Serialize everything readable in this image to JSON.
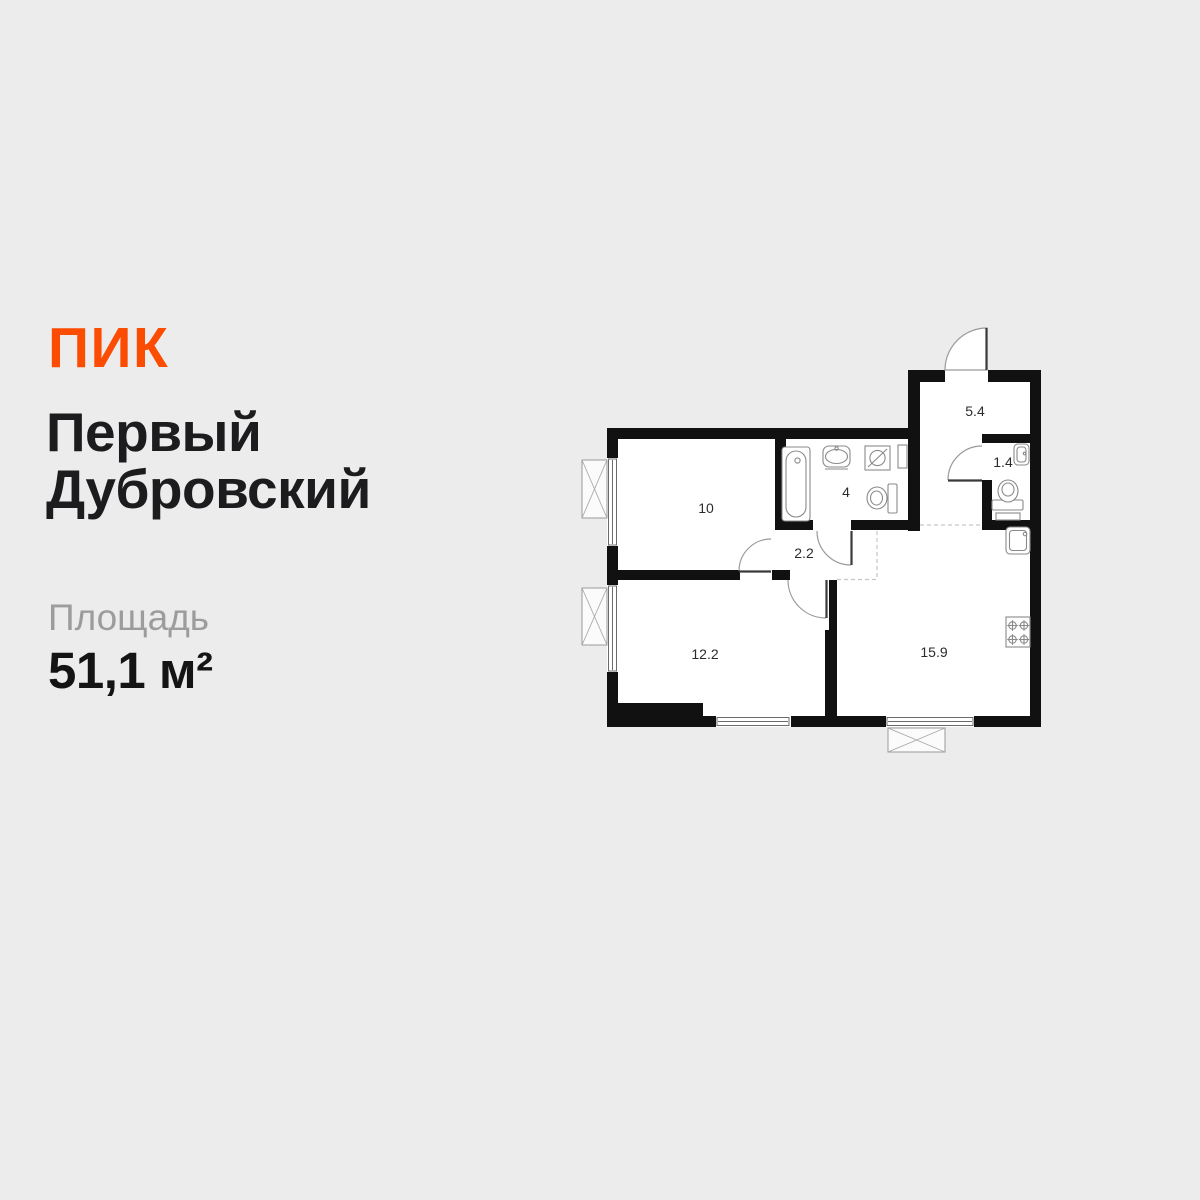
{
  "background_color": "#ECECEC",
  "brand": {
    "name": "ПИК",
    "color": "#FC4C02"
  },
  "project": {
    "line1": "Первый",
    "line2": "Дубровский"
  },
  "area": {
    "label": "Площадь",
    "value": "51,1 м²"
  },
  "floorplan": {
    "wall_color": "#111111",
    "rooms": [
      {
        "name": "bedroom-top",
        "area_label": "10"
      },
      {
        "name": "bathroom",
        "area_label": "4"
      },
      {
        "name": "hallway",
        "area_label": "2.2"
      },
      {
        "name": "entry-hall",
        "area_label": "5.4"
      },
      {
        "name": "wc",
        "area_label": "1.4"
      },
      {
        "name": "bedroom-bottom",
        "area_label": "12.2"
      },
      {
        "name": "kitchen-living-room",
        "area_label": "15.9"
      }
    ],
    "fixture_icons": [
      "bathtub-icon",
      "sink-icon",
      "washing-machine-icon",
      "toilet-icon",
      "cabinet-icon",
      "kitchen-sink-icon",
      "stove-icon",
      "window-icon",
      "ac-basket-icon",
      "door-swing-icon"
    ]
  }
}
